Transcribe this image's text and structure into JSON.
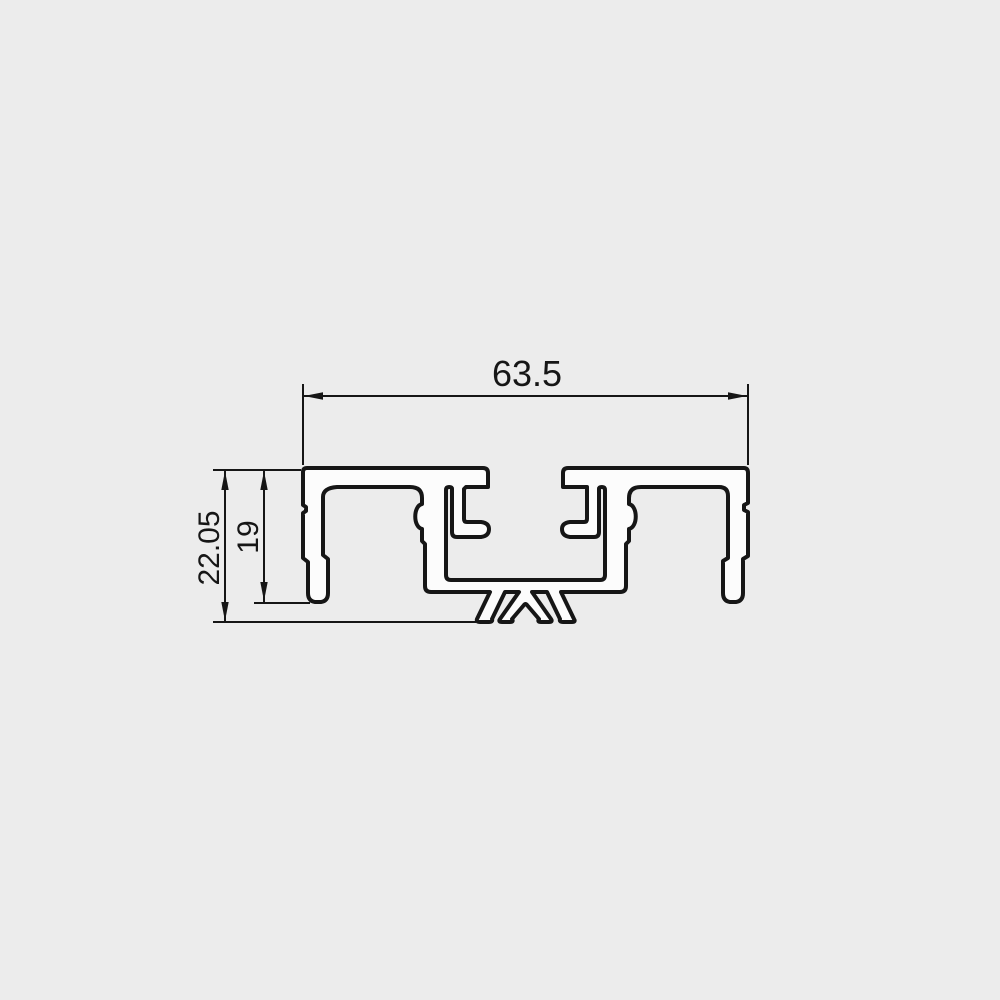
{
  "colors": {
    "background": "#ececec",
    "line": "#161616",
    "profile_fill": "#fcfcfc"
  },
  "dimensions": {
    "width_label": "63.5",
    "overall_height_label": "22.05",
    "inner_height_label": "19"
  }
}
